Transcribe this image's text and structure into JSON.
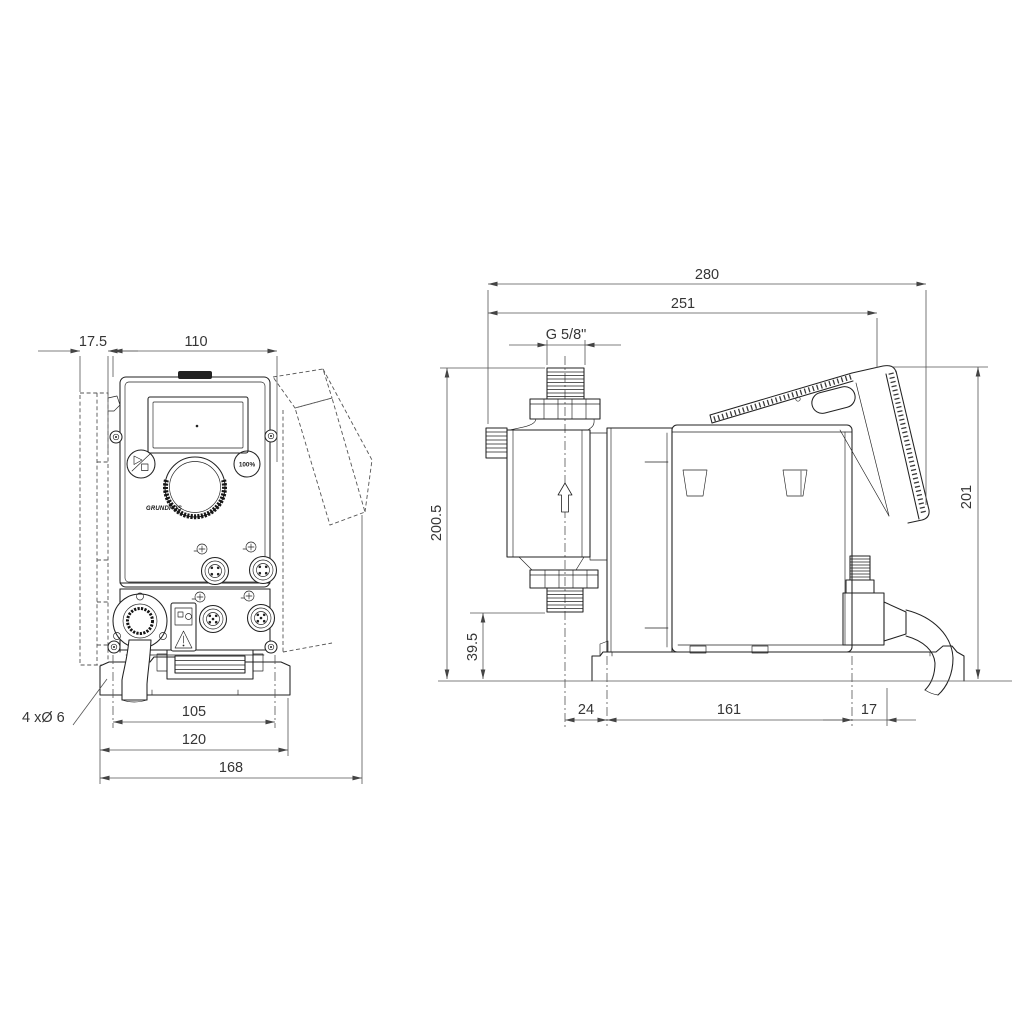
{
  "drawing_type": "dimensional technical drawing, dosing pump, front and side views",
  "dims": {
    "front": {
      "offset": "17.5",
      "width": "110",
      "holes": "105",
      "base": "120",
      "overall": "168",
      "holes_note": "4 xØ 6"
    },
    "side": {
      "depth": "280",
      "panel_depth": "251",
      "thread": "G 5/8\"",
      "height_conn": "200.5",
      "height_valve": "39.5",
      "height": "201",
      "front_off": "24",
      "holes": "161",
      "rear_off": "17"
    }
  },
  "labels": {
    "percent": "100%",
    "brand": "GRUNDFOS"
  },
  "colors": {
    "line": "#222222",
    "dimension": "#555555",
    "background": "#ffffff"
  }
}
